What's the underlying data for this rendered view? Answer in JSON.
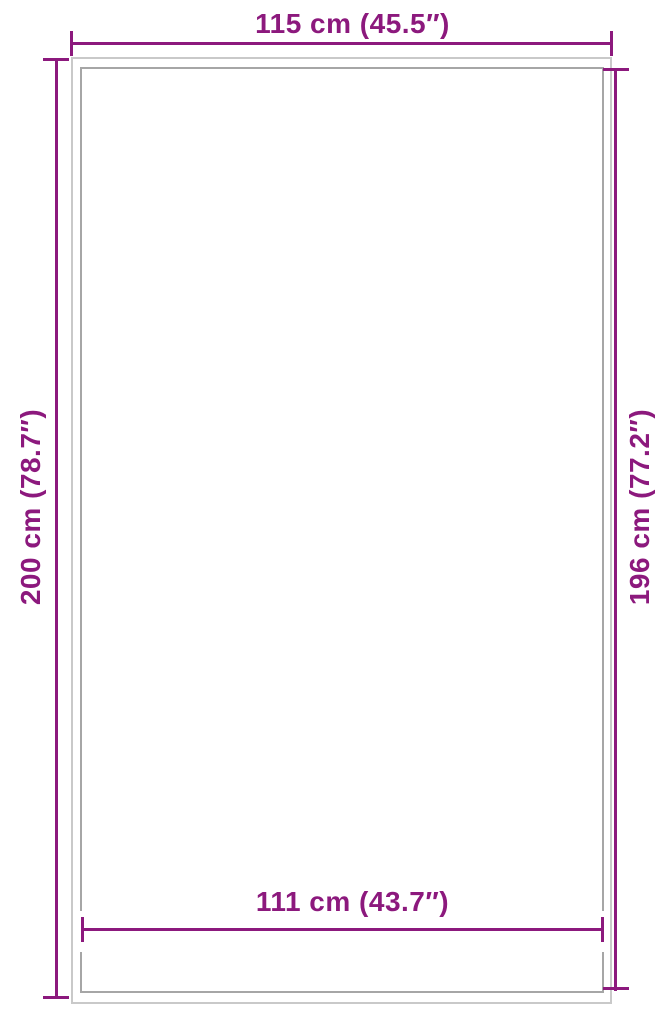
{
  "colors": {
    "accent": "#8C197D",
    "outer_border": "#C9C9C9",
    "inner_border": "#A6A6A6",
    "background": "#FFFFFF"
  },
  "diagram": {
    "type": "product-dimension-diagram",
    "dimensions": {
      "top": {
        "label": "115 cm (45.5″)",
        "value_cm": 115,
        "value_in": 45.5
      },
      "bottom": {
        "label": "111 cm (43.7″)",
        "value_cm": 111,
        "value_in": 43.7
      },
      "left": {
        "label": "200 cm (78.7″)",
        "value_cm": 200,
        "value_in": 78.7
      },
      "right": {
        "label": "196 cm (77.2″)",
        "value_cm": 196,
        "value_in": 77.2
      }
    }
  }
}
